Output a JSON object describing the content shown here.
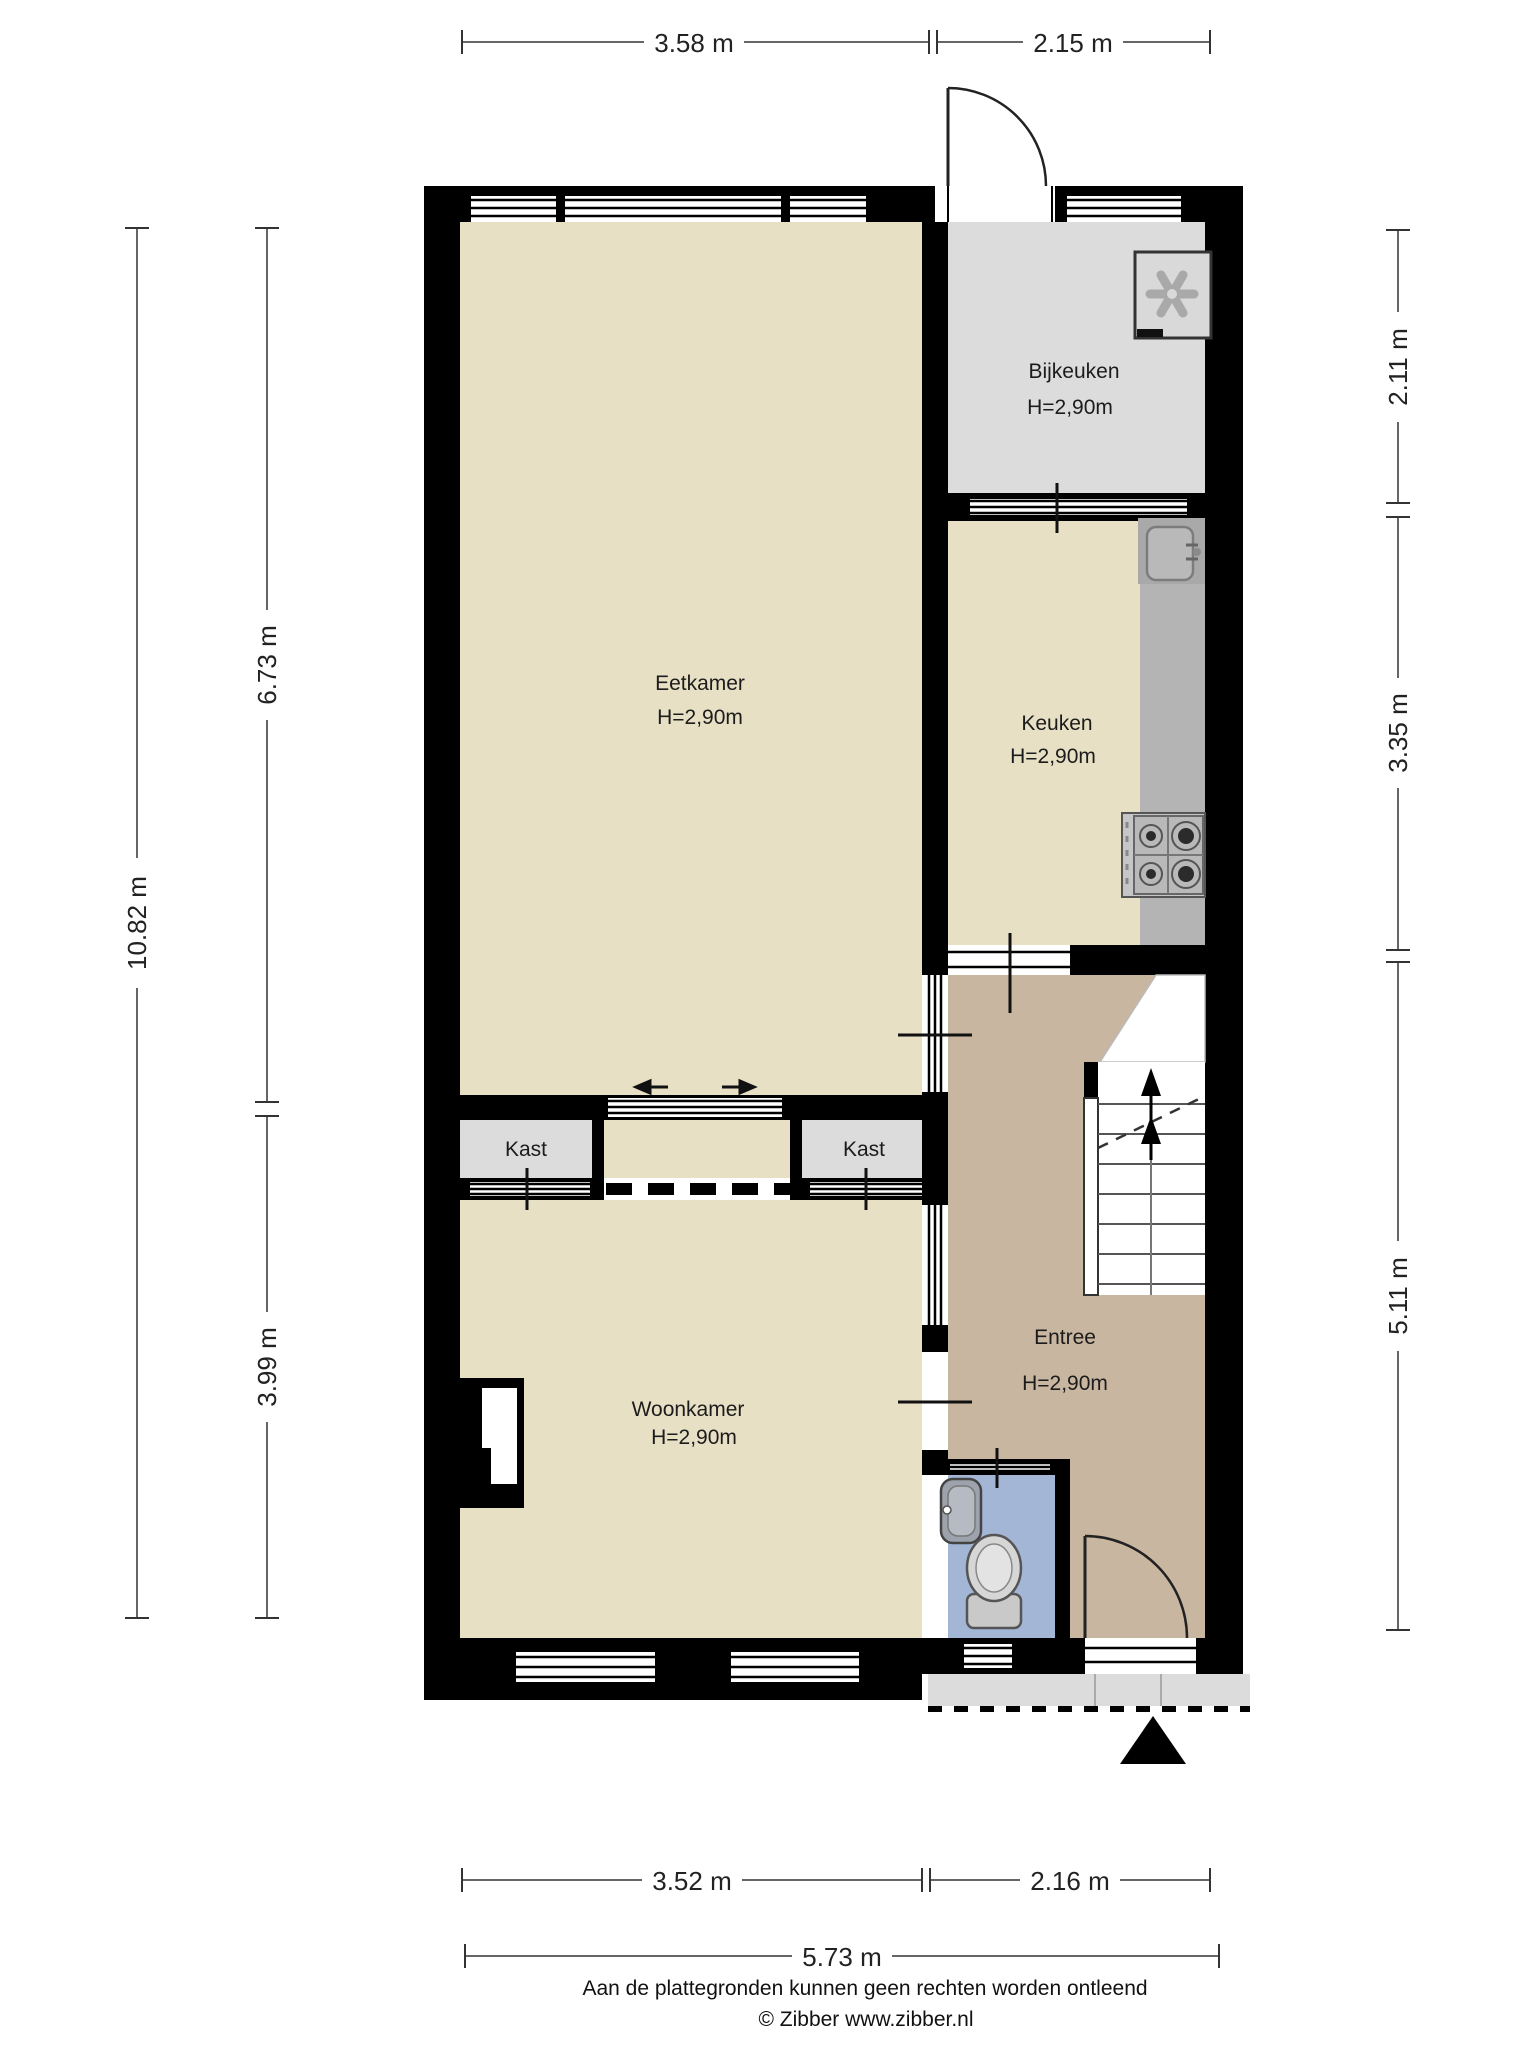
{
  "rooms": {
    "eetkamer": {
      "name": "Eetkamer",
      "height": "H=2,90m"
    },
    "bijkeuken": {
      "name": "Bijkeuken",
      "height": "H=2,90m"
    },
    "keuken": {
      "name": "Keuken",
      "height": "H=2,90m"
    },
    "woonkamer": {
      "name": "Woonkamer",
      "height": "H=2,90m"
    },
    "entree": {
      "name": "Entree",
      "height": "H=2,90m"
    },
    "kast_left": {
      "name": "Kast"
    },
    "kast_right": {
      "name": "Kast"
    }
  },
  "dimensions": {
    "top": {
      "a": "3.58 m",
      "b": "2.15 m"
    },
    "right": {
      "a": "2.11 m",
      "b": "3.35 m",
      "c": "5.11 m"
    },
    "left": {
      "total": "10.82 m",
      "a": "6.73 m",
      "b": "3.99 m"
    },
    "bottom": {
      "a": "3.52 m",
      "b": "2.16 m",
      "total": "5.73 m"
    }
  },
  "footer": {
    "disclaimer": "Aan de plattegronden kunnen geen rechten worden ontleend",
    "copyright": "© Zibber www.zibber.nl"
  },
  "colors": {
    "wall": "#000000",
    "floor_living": "#e8e0c5",
    "floor_utility": "#dcdcdc",
    "floor_hall": "#c8b6a0",
    "floor_wc": "#a3b6d6",
    "counter": "#b4b4b4",
    "counter_block": "#a9a9a9",
    "porch": "#dcdcdc",
    "fixture_gray": "#c9c9c9"
  },
  "icons": {
    "boiler": "fan-unit-icon",
    "sink": "kitchen-sink-icon",
    "stove": "gas-hob-icon",
    "wc_sink": "hand-basin-icon",
    "toilet": "toilet-icon",
    "stairs": "stairs-up-icon",
    "entrance": "entrance-arrow-icon",
    "sliding_door": "sliding-door-arrows-icon"
  }
}
